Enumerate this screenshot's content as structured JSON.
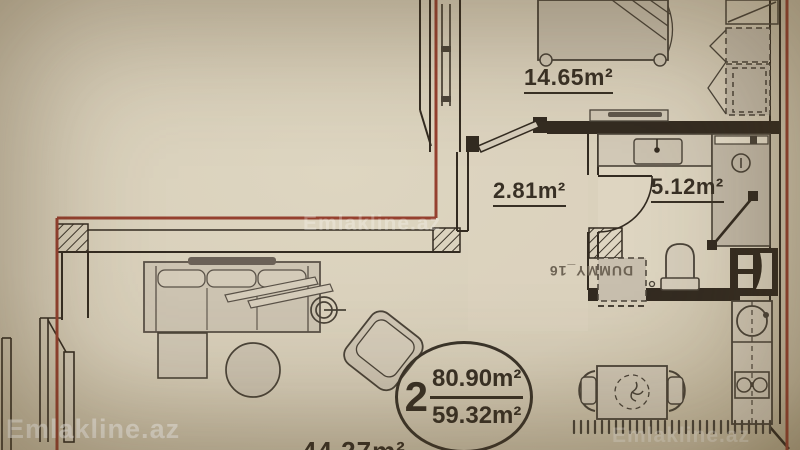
{
  "title": "Apartment floor plan",
  "rooms": {
    "bedroom": {
      "area": "14.65m²"
    },
    "hallway": {
      "area": "2.81m²"
    },
    "bathroom": {
      "area": "5.12m²"
    },
    "living_room": {
      "area": "44.27m²"
    }
  },
  "unit_badge": {
    "number": "2",
    "total_area": "80.90m²",
    "living_area": "59.32m²"
  },
  "cad_placeholder": "DUMMY_16",
  "watermark": "Emlakline.az",
  "colors": {
    "background": "#d8cfba",
    "wall": "#332b21",
    "boundary_red": "#95402f",
    "furniture_fill": "#cfc6b4",
    "label_text": "#383025"
  }
}
